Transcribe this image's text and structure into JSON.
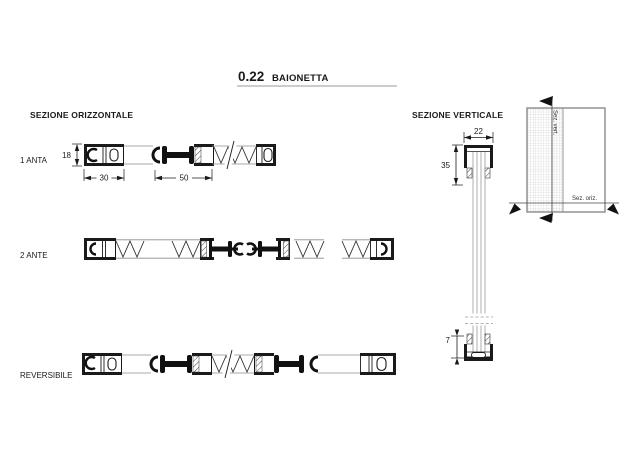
{
  "title": {
    "code": "0.22",
    "name": "BAIONETTA"
  },
  "headers": {
    "horizontal": "SEZIONE ORIZZONTALE",
    "vertical": "SEZIONE VERTICALE"
  },
  "rows": {
    "r1": "1 ANTA",
    "r2": "2 ANTE",
    "r3": "REVERSIBILE"
  },
  "dims": {
    "profile_height": "18",
    "frame_width": "30",
    "sash_width": "50",
    "top_width": "22",
    "top_height": "35",
    "bottom_gap": "7"
  },
  "elevation": {
    "vertical_cut_label": "Sez. vert.",
    "horizontal_cut_label": "Sez. oriz."
  },
  "colors": {
    "ink": "#1a1a1a",
    "light_line": "#8c8c8c",
    "background": "#ffffff"
  }
}
